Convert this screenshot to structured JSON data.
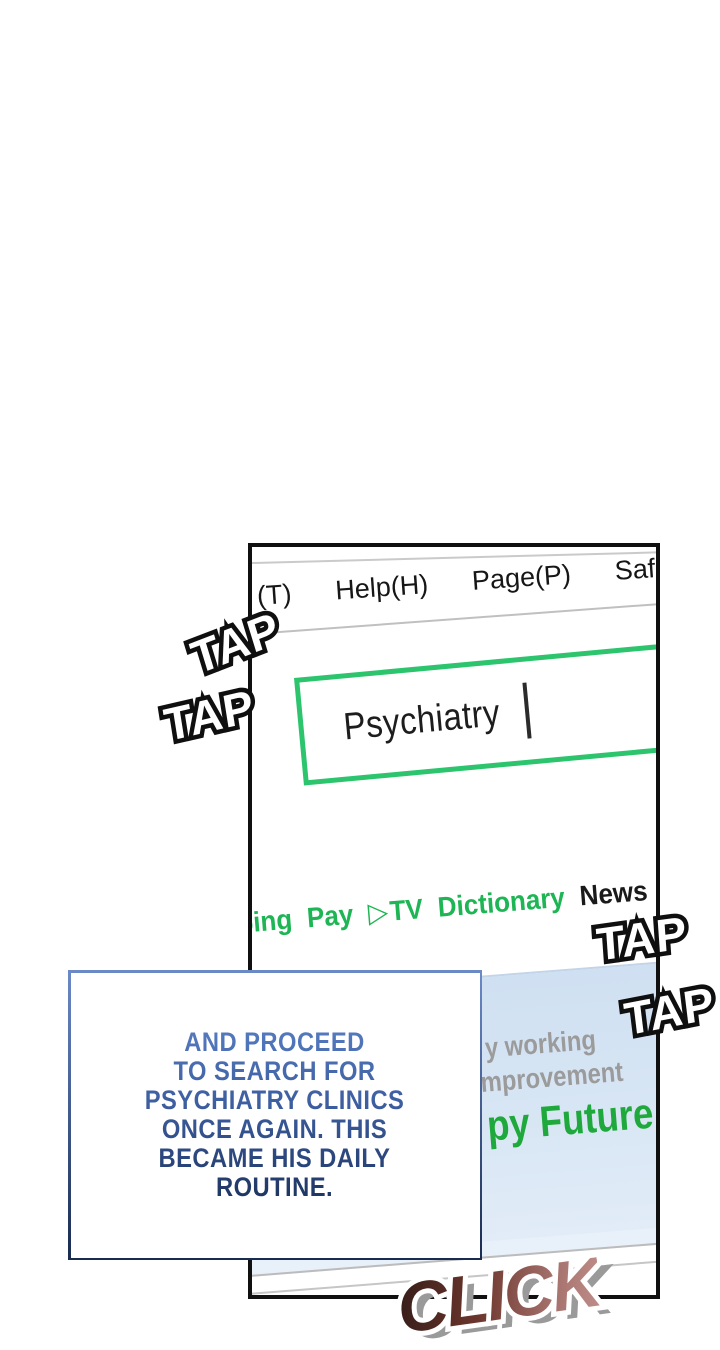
{
  "panel": {
    "menu_items": [
      "(T)",
      "Help(H)",
      "Page(P)",
      "Safe"
    ],
    "search": {
      "value": "Psychiatry"
    },
    "nav": {
      "items": [
        "ping",
        "Pay",
        "TV",
        "Dictionary",
        "News"
      ],
      "play_icon": "▷"
    },
    "banner": {
      "text_line1": "y working",
      "text_line2": "mprovement",
      "headline": "py Future"
    }
  },
  "caption": {
    "lines": [
      "AND PROCEED",
      "TO SEARCH FOR",
      "PSYCHIATRY CLINICS",
      "ONCE AGAIN. THIS",
      "BECAME HIS DAILY",
      "ROUTINE."
    ]
  },
  "sfx": {
    "tap": "TAP",
    "click": "CLICK"
  },
  "colors": {
    "panel_border": "#101010",
    "search_border": "#2dc46e",
    "nav_green": "#1eb554",
    "news_black": "#1a1a1a",
    "banner_blue": "#d8e6f4",
    "headline_green": "#1fa93c",
    "caption_blue": "#557abf",
    "caption_navy": "#1d3460",
    "click_dark": "#3a1f1a",
    "click_light": "#bc8a86",
    "tap_fill": "#ffffff",
    "tap_outline": "#0f0f0f"
  }
}
